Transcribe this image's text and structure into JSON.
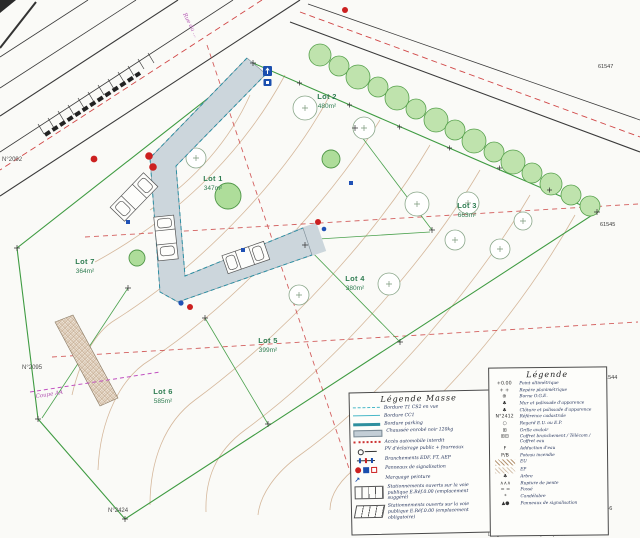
{
  "meta": {
    "description": "Plan de masse scanné d'un lotissement de 7 lots"
  },
  "colors": {
    "paper": "#fafaf7",
    "road_fill": "#ccd6dc",
    "road_edge": "#2b8fa3",
    "boundary_green": "#3f9b42",
    "hedge_green": "#bfe3ad",
    "lot_label_green": "#2f7d52",
    "contour_tan": "#c9a27e",
    "axis_red": "#cc3333",
    "marker_red": "#cc2020",
    "marker_blue": "#2051b5",
    "annotation_magenta": "#b04fb0",
    "linework": "#3a3a3a"
  },
  "lots": [
    {
      "name": "Lot 1",
      "area": "347m²"
    },
    {
      "name": "Lot 2",
      "area": "480m²"
    },
    {
      "name": "Lot 3",
      "area": "663m²"
    },
    {
      "name": "Lot 4",
      "area": "380m²"
    },
    {
      "name": "Lot 5",
      "area": "399m²"
    },
    {
      "name": "Lot 6",
      "area": "585m²"
    },
    {
      "name": "Lot 7",
      "area": "364m²"
    }
  ],
  "parcels": {
    "left_top": "N°2092",
    "left_mid": "N°2095",
    "bottom": "N°2424"
  },
  "corner_refs": {
    "top_right": "61547",
    "right_upper": "61545",
    "right_lower": "61544",
    "bottom_right": "61546"
  },
  "street_label": "Rue du ...",
  "section_label": "Coupe AA",
  "bottom_note": "L'alignement de la voie publique ...",
  "legend_masse": {
    "title": "Légende  Masse",
    "items": [
      {
        "label": "Bordure T1 CS2 en vue"
      },
      {
        "label": "Bordure CC1"
      },
      {
        "label": "Bordure parking"
      },
      {
        "label": "Chaussée enrobé noir 120kg"
      },
      {
        "label": "Accès automobile interdit"
      },
      {
        "label": "PV d'éclairage public + fourreaux"
      },
      {
        "label": "Branchements EDF, FT, AEP"
      },
      {
        "label": "Panneaux de signalisation"
      },
      {
        "label": "Marquage peinture",
        "sym": "↗"
      },
      {
        "label": "Stationnements ouverts sur la voie publique E.Réf.0.00 (emplacement suggéré)"
      },
      {
        "label": "Stationnements ouverts sur la voie publique E.Réf.0.00 (emplacement obligatoire)"
      }
    ]
  },
  "legend": {
    "title": "Légende",
    "items": [
      {
        "sym": "+0.00",
        "label": "Point altimétrique"
      },
      {
        "sym": "+  +",
        "label": "Repère planimétrique"
      },
      {
        "sym": "⊕",
        "label": "Borne O.G.E."
      },
      {
        "sym": "♣",
        "label": "Mur et palissade d'apparence"
      },
      {
        "sym": "♣",
        "label": "Clôture et palissade d'apparence"
      },
      {
        "sym": "N°2412",
        "label": "Référence cadastrale"
      },
      {
        "sym": "○",
        "label": "Regard E.U. ou E.P."
      },
      {
        "sym": "⊞",
        "label": "Grille avaloir"
      },
      {
        "sym": "⊞⊟",
        "label": "Coffret branchement / Télécom / Coffret eau"
      },
      {
        "sym": "F",
        "label": "Adduction d'eau"
      },
      {
        "sym": "P/B",
        "label": "Poteau incendie"
      },
      {
        "sym": "",
        "label": "EU"
      },
      {
        "sym": "",
        "label": "EP"
      },
      {
        "sym": "♣",
        "label": "Arbre"
      },
      {
        "sym": "∧∧∧",
        "label": "Rupture de pente"
      },
      {
        "sym": "= =",
        "label": "Fossé"
      },
      {
        "sym": "*",
        "label": "Candélabre"
      },
      {
        "sym": "▲●",
        "label": "Panneaux de signalisation"
      }
    ]
  }
}
